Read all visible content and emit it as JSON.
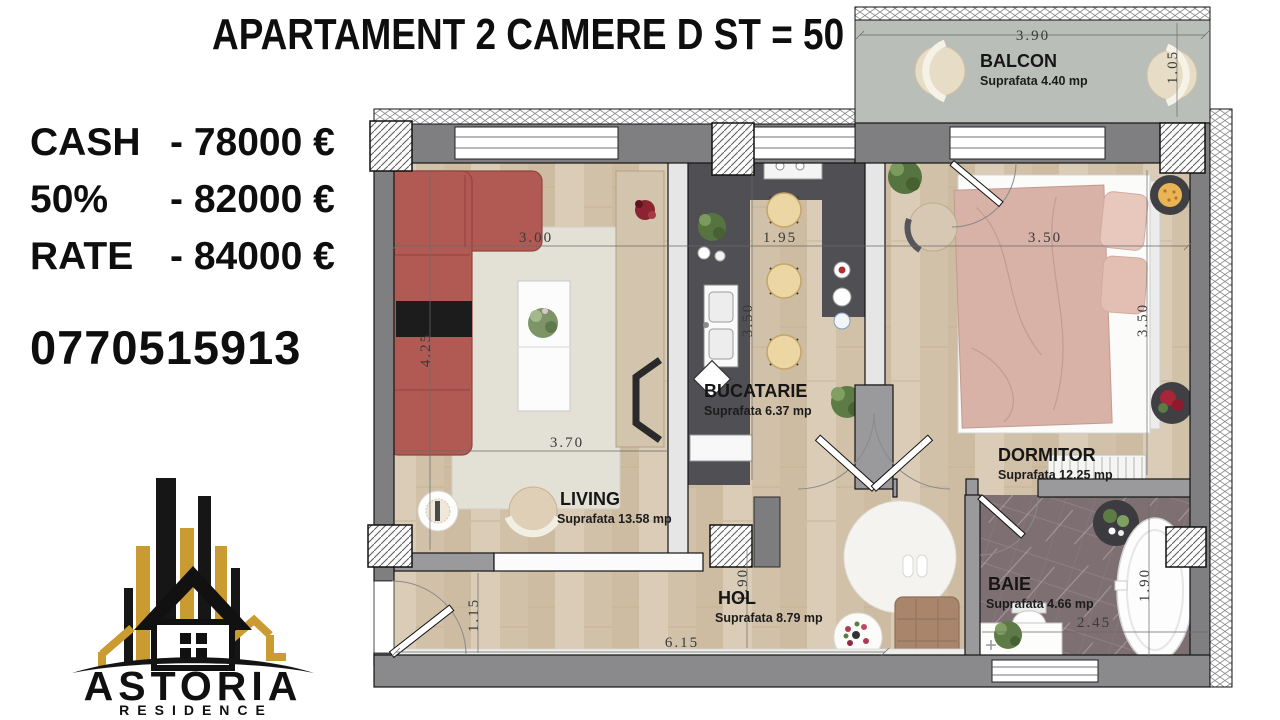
{
  "title": "APARTAMENT 2 CAMERE D ST = 50 MP",
  "pricing": {
    "rows": [
      {
        "label": "CASH",
        "value": "- 78000 €"
      },
      {
        "label": "50%",
        "value": "- 82000 €"
      },
      {
        "label": "RATE",
        "value": "- 84000 €"
      }
    ],
    "phone": "0770515913"
  },
  "logo": {
    "name": "ASTORIA",
    "subtitle": "RESIDENCE"
  },
  "floorplan": {
    "rooms": [
      {
        "name": "BALCON",
        "area": "Suprafata 4.40 mp"
      },
      {
        "name": "LIVING",
        "area": "Suprafata 13.58 mp"
      },
      {
        "name": "BUCATARIE",
        "area": "Suprafata 6.37 mp"
      },
      {
        "name": "DORMITOR",
        "area": "Suprafata 12.25 mp"
      },
      {
        "name": "HOL",
        "area": "Suprafata 8.79 mp"
      },
      {
        "name": "BAIE",
        "area": "Suprafata 4.66 mp"
      }
    ],
    "dims": {
      "balcon_w": "3.90",
      "balcon_d": "1.05",
      "living_w": "3.00",
      "living_h": "4.25",
      "living_w2": "3.70",
      "kitchen_w": "1.95",
      "kitchen_h": "3.50",
      "bedroom_w": "3.50",
      "bedroom_h": "3.50",
      "hall_w": "6.15",
      "hall_h": "1.90",
      "entry_w": "1.15",
      "bath_w": "2.45",
      "bath_h": "1.90"
    },
    "colors": {
      "brand_gold": "#c99b31",
      "wall_gray": "#7f7f82",
      "wood_floor": "#d5c6af",
      "kitchen_floor": "#4f4f54",
      "bath_floor": "#7e6f72",
      "balcony_floor": "#b9beb8",
      "sofa_red": "#b15a54",
      "bed_blush": "#d8b2a7",
      "stool_beige": "#ecd6a4"
    }
  }
}
